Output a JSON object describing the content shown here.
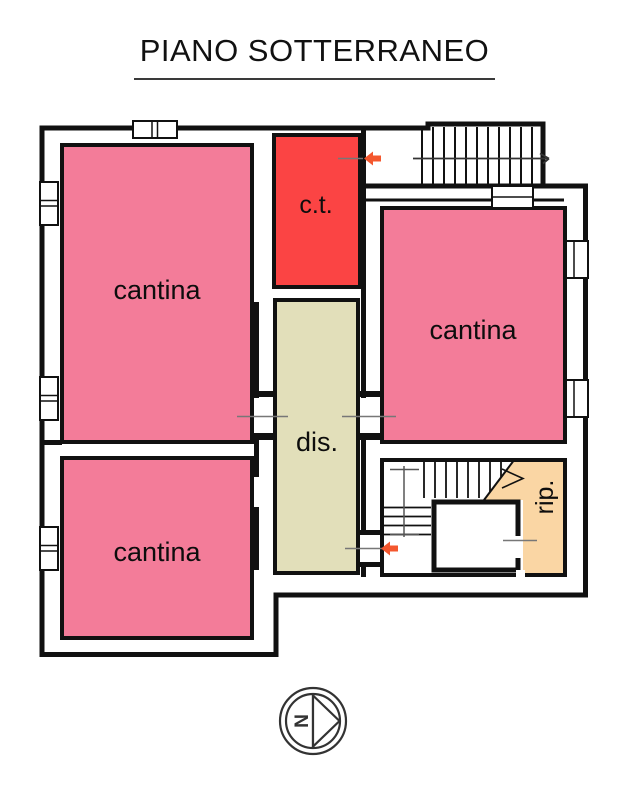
{
  "title": "PIANO SOTTERRANEO",
  "rooms": {
    "cantina_top_left": {
      "label": "cantina"
    },
    "cantina_right": {
      "label": "cantina"
    },
    "cantina_bottom_left": {
      "label": "cantina"
    },
    "boiler_room": {
      "label": "c.t."
    },
    "hallway": {
      "label": "dis."
    },
    "storage": {
      "label": "rip."
    }
  },
  "compass": {
    "north_label": "N"
  },
  "colors": {
    "cantina": "#F37C99",
    "boiler": "#FB4444",
    "hallway": "#E2DFBA",
    "storage": "#FAD6A4",
    "wall": "#111111",
    "door_line": "#777777",
    "arrow": "#F4572E"
  }
}
